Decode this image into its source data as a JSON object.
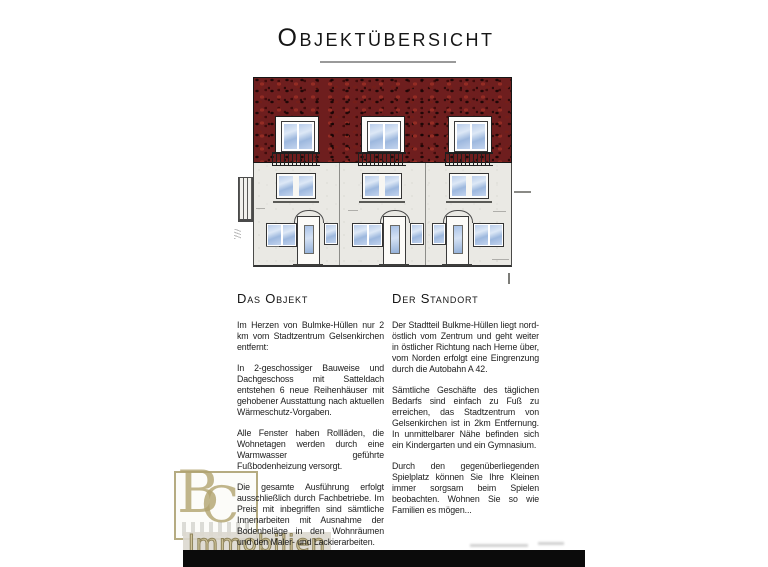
{
  "page": {
    "title": "Objektübersicht"
  },
  "sections": {
    "object": {
      "heading": "Das Objekt",
      "paragraphs": [
        "Im Herzen von Bulmke-Hüllen nur 2 km vom Stadtzentrum Gelsenkirchen entfernt:",
        "In 2-geschossiger Bauweise und Dachgeschoss mit Satteldach entstehen 6 neue Reihenhäuser mit gehobener Ausstattung nach aktuellen Wärmeschutz-Vorgaben.",
        "Alle Fenster haben Rollläden, die Wohnetagen werden durch eine Warmwasser geführte Fußbodenheizung versorgt.",
        "Die gesamte Ausführung erfolgt ausschließlich durch Fachbetriebe. Im Preis mit inbegriffen sind sämtliche Innenarbeiten mit Ausnahme der Bodenbeläge in den Wohnräumen und den Maler- und Lackierarbeiten."
      ]
    },
    "location": {
      "heading": "Der Standort",
      "paragraphs": [
        "Der Stadtteil Bulkme-Hüllen liegt nord-östlich vom Zentrum und geht weiter in östlicher Richtung nach Herne über, vom Norden erfolgt eine Eingrenzung durch die Autobahn A 42.",
        "Sämtliche Geschäfte des täglichen Bedarfs sind einfach zu Fuß zu erreichen, das Stadtzentrum von Gelsenkirchen ist in 2km Entfernung. In unmittelbarer Nähe befinden sich ein Kindergarten und ein Gymnasium.",
        "Durch den gegenüberliegenden Spielplatz können Sie Ihre Kleinen immer sorgsam beim Spielen beobachten. Wohnen Sie so wie Familien es mögen..."
      ]
    }
  },
  "watermark": {
    "monogram_first": "B",
    "monogram_second": "C",
    "label": "Immobilien"
  },
  "colors": {
    "roof": "#6e1e1e",
    "facade": "#eae9e4",
    "window_glass": "#a9c2e6",
    "watermark_gold": "#a89c6c",
    "scan_bar": "#0b0b0b"
  }
}
